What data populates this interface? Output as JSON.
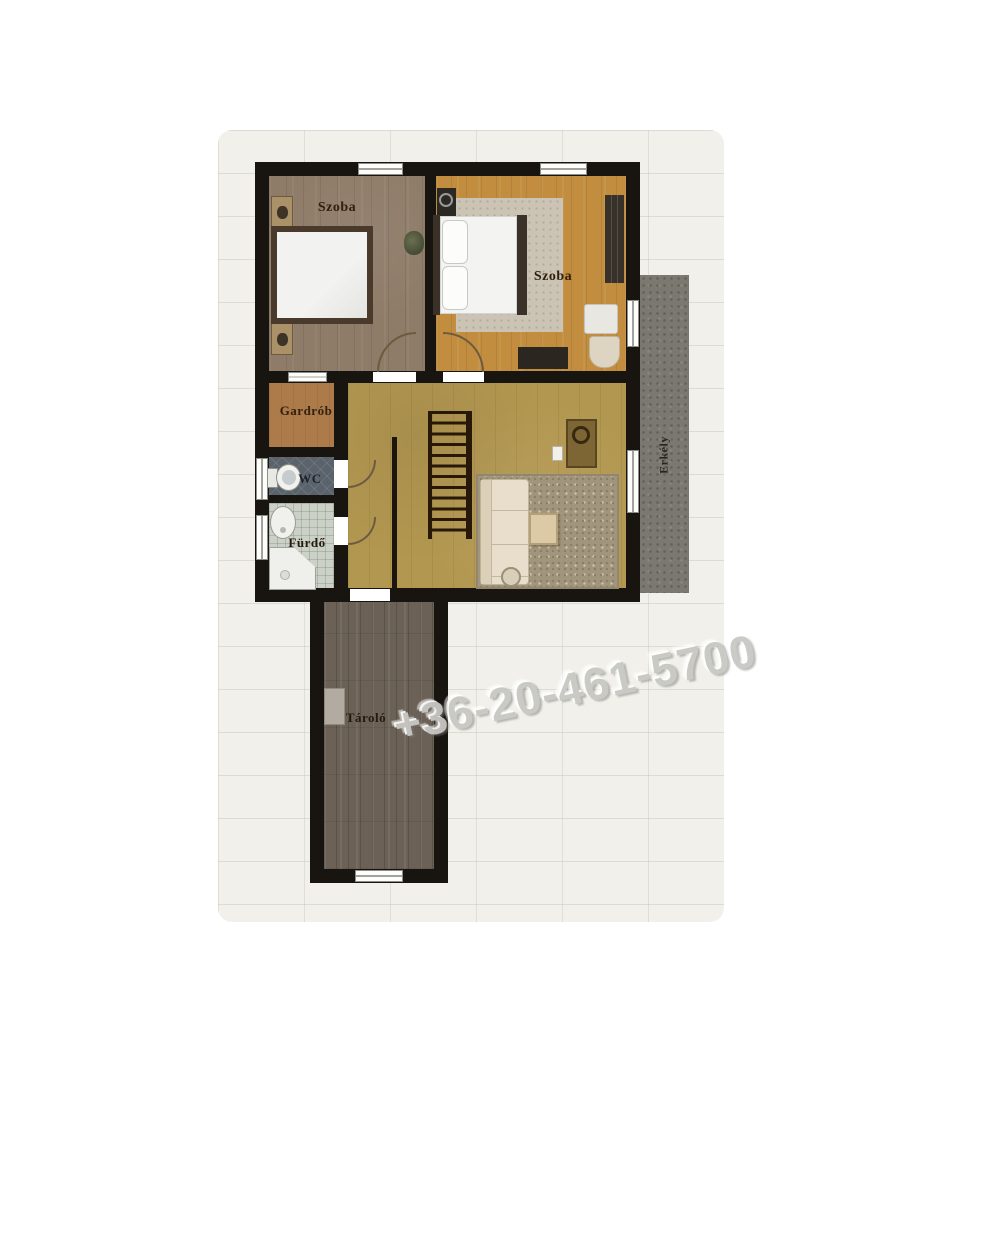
{
  "floorplan": {
    "rooms": [
      {
        "id": "bedroom-left",
        "label": "Szoba",
        "floor_color": "#8e7b68"
      },
      {
        "id": "bedroom-right",
        "label": "Szoba",
        "floor_color": "#c28d3e"
      },
      {
        "id": "wardrobe",
        "label": "Gardrób",
        "floor_color": "#ad7a4a"
      },
      {
        "id": "wc",
        "label": "WC",
        "floor_color": "#5a636c"
      },
      {
        "id": "bathroom",
        "label": "Fürdő",
        "floor_color": "#cbd1c7"
      },
      {
        "id": "storage",
        "label": "Tároló",
        "floor_color": "#6b6157"
      },
      {
        "id": "balcony",
        "label": "Erkély",
        "floor_color": "#7a7970"
      }
    ],
    "watermark": {
      "text": "+36-20-461-5700",
      "color": "#c8c8c4"
    },
    "wall_color": "#18140f",
    "background_color": "#f1f0ea"
  }
}
